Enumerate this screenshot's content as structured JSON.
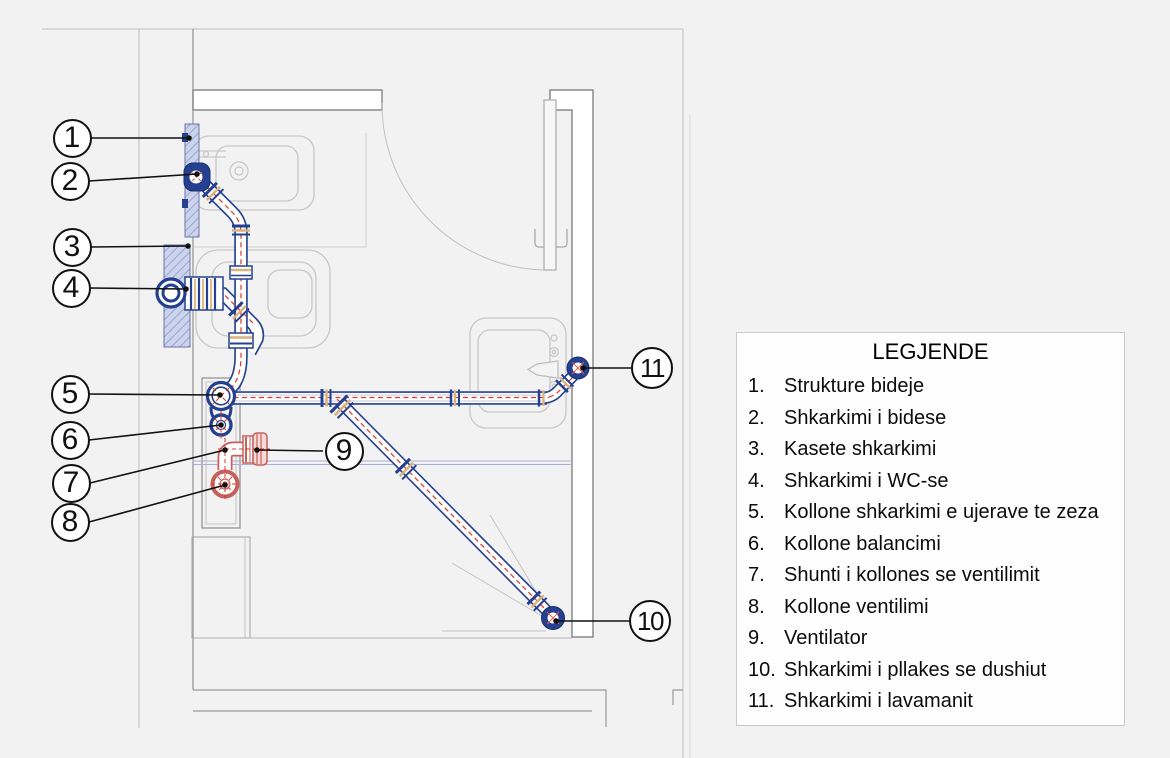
{
  "legend": {
    "title": "LEGJENDE",
    "items": [
      {
        "num": "1.",
        "label": "Strukture bideje"
      },
      {
        "num": "2.",
        "label": "Shkarkimi i bidese"
      },
      {
        "num": "3.",
        "label": "Kasete shkarkimi"
      },
      {
        "num": "4.",
        "label": "Shkarkimi i WC-se"
      },
      {
        "num": "5.",
        "label": "Kollone shkarkimi e ujerave te zeza"
      },
      {
        "num": "6.",
        "label": "Kollone balancimi"
      },
      {
        "num": "7.",
        "label": "Shunti i kollones se ventilimit"
      },
      {
        "num": "8.",
        "label": "Kollone ventilimi"
      },
      {
        "num": "9.",
        "label": "Ventilator"
      },
      {
        "num": "10.",
        "label": "Shkarkimi i pllakes se dushiut"
      },
      {
        "num": "11.",
        "label": "Shkarkimi i lavamanit"
      }
    ]
  },
  "callouts": [
    {
      "num": "1"
    },
    {
      "num": "2"
    },
    {
      "num": "3"
    },
    {
      "num": "4"
    },
    {
      "num": "5"
    },
    {
      "num": "6"
    },
    {
      "num": "7"
    },
    {
      "num": "8"
    },
    {
      "num": "9"
    },
    {
      "num": "10"
    },
    {
      "num": "11"
    }
  ],
  "colors": {
    "background": "#f2f2f2",
    "drain_pipe_blue": "#24408f",
    "vent_pipe_red": "#c5605c",
    "centerline_red": "#e03428",
    "gasket_tan": "#d9b27c",
    "plate_hatch": "#ccd3ed"
  }
}
